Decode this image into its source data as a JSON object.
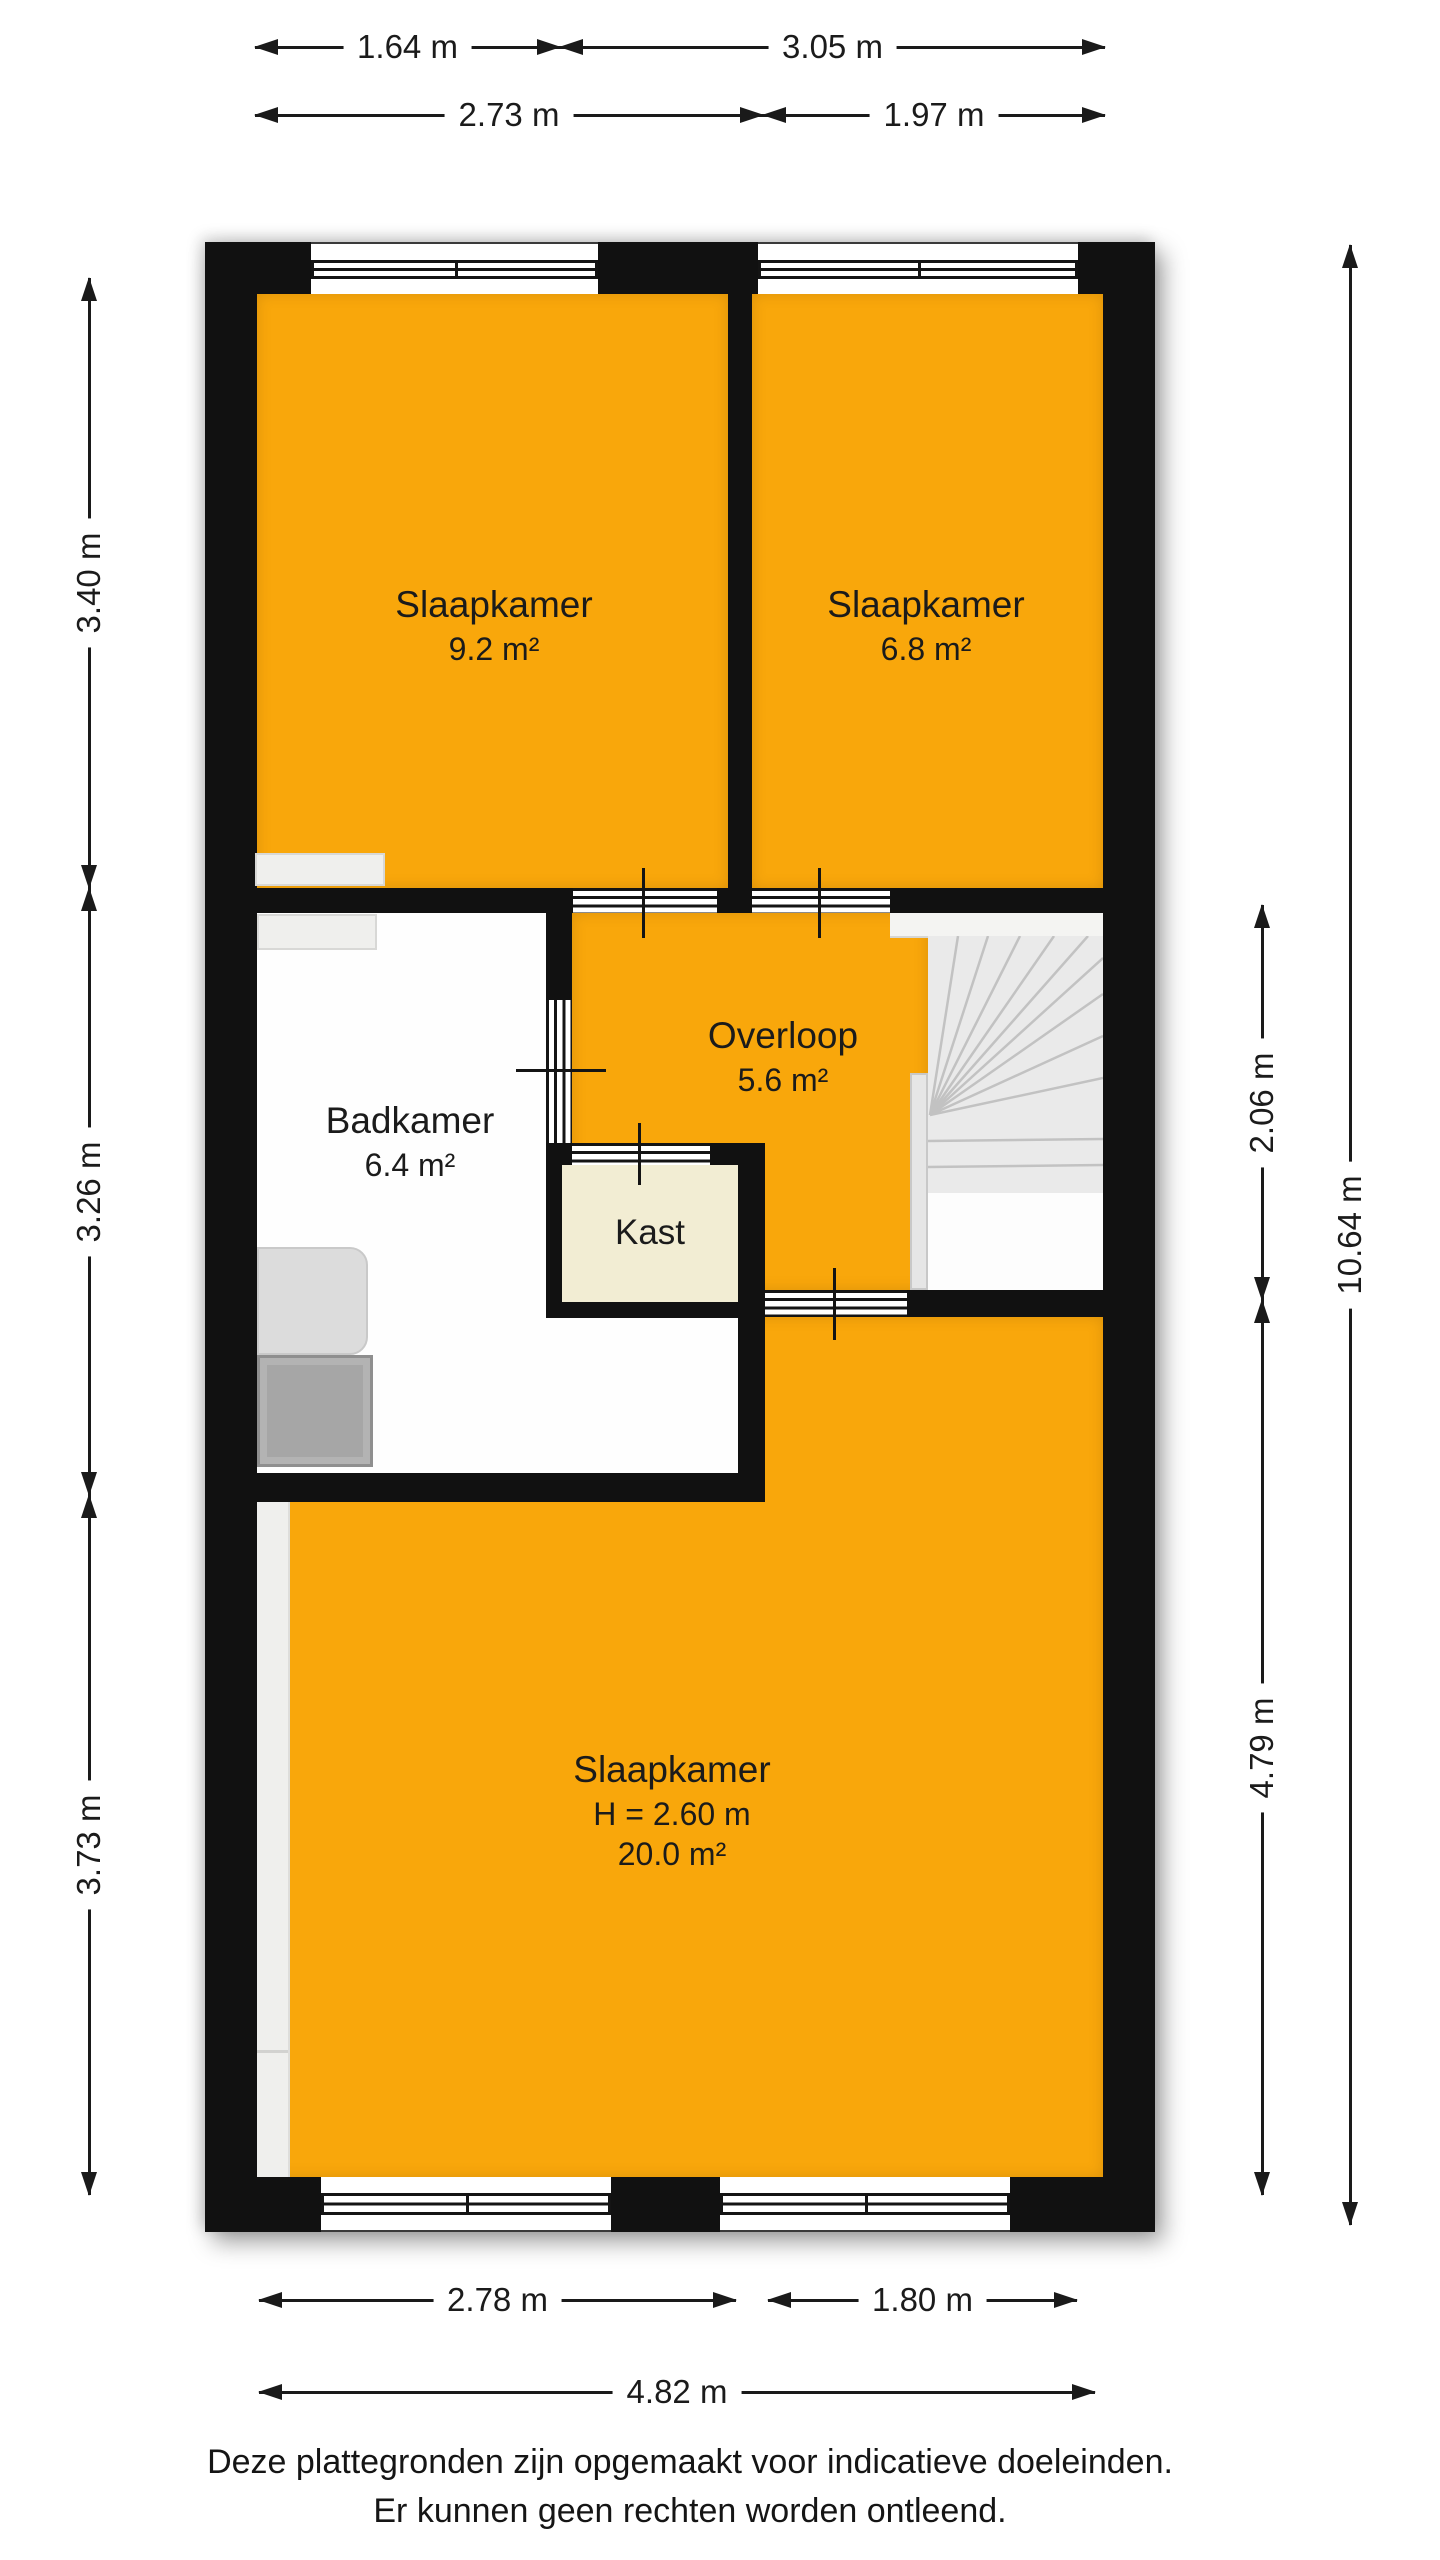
{
  "page": {
    "title": "floor-plan-upper-storey",
    "background": "#ffffff",
    "footer": {
      "line1": "Deze plattegronden zijn opgemaakt voor indicatieve doeleinden.",
      "line2": "Er kunnen geen rechten worden ontleend."
    }
  },
  "palette": {
    "wall": "#111111",
    "room_orange": "#F9A70B",
    "kast_cream": "#F2EDD3",
    "bath_white": "#FEFEFE",
    "stairs_gray": "#EAEAEA",
    "fixture_light": "#DCDCDC",
    "fixture_dark": "#A6A6A6"
  },
  "rooms": {
    "slaapkamer_tl": {
      "name": "Slaapkamer",
      "area": "9.2 m²"
    },
    "slaapkamer_tr": {
      "name": "Slaapkamer",
      "area": "6.8 m²"
    },
    "badkamer": {
      "name": "Badkamer",
      "area": "6.4 m²"
    },
    "overloop": {
      "name": "Overloop",
      "area": "5.6 m²"
    },
    "kast": {
      "name": "Kast"
    },
    "slaapkamer_b": {
      "name": "Slaapkamer",
      "height": "H = 2.60 m",
      "area": "20.0 m²"
    }
  },
  "dimensions": {
    "t164": {
      "label": "1.64 m"
    },
    "t305": {
      "label": "3.05 m"
    },
    "t273": {
      "label": "2.73 m"
    },
    "t197": {
      "label": "1.97 m"
    },
    "l340": {
      "label": "3.40 m"
    },
    "l326": {
      "label": "3.26 m"
    },
    "l373": {
      "label": "3.73 m"
    },
    "r206": {
      "label": "2.06 m"
    },
    "r479": {
      "label": "4.79 m"
    },
    "r1064": {
      "label": "10.64 m"
    },
    "b278": {
      "label": "2.78 m"
    },
    "b180": {
      "label": "1.80 m"
    },
    "b482": {
      "label": "4.82 m"
    }
  }
}
